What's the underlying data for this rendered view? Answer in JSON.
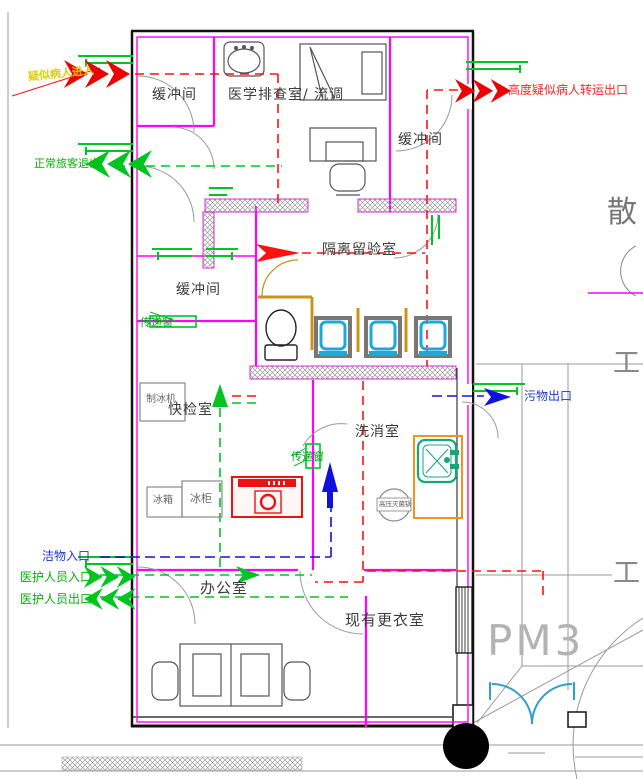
{
  "drawing": {
    "rooms": {
      "buffer_top_left": "缓冲间",
      "medical_screening": "医学排查室/ 流调",
      "buffer_top_right": "缓冲间",
      "isolation_room": "隔离留验室",
      "buffer_mid_left": "缓冲间",
      "rapid_test": "快检室",
      "wash_room": "洗消室",
      "office": "办公室",
      "changing_room": "现有更衣室"
    },
    "flows": {
      "suspected_entry": "疑似病人进入",
      "transfer_exit": "高度疑似病人转运出口",
      "normal_exit": "正常旅客退出",
      "waste_exit": "污物出口",
      "clean_entry": "洁物入口",
      "staff_entry": "医护人员入口",
      "staff_exit": "医护人员出口"
    },
    "equipment": {
      "ice_machine": "制冰机",
      "fridge": "冰箱",
      "freezer": "冰柜",
      "autoclave": "高压灭菌锅",
      "pass_window_upper": "传递窗",
      "pass_window_lower": "传递窗"
    },
    "annotations": {
      "pm3": "PM3",
      "scatter_partial": "散",
      "steel_1": "工",
      "steel_2": "工"
    },
    "colors": {
      "partition": "#ff00ff",
      "suspected_route": "#ff1111",
      "clean_route": "#00c422",
      "waste_route": "#1111dd",
      "stall_wood": "#c8941c",
      "door_blue": "#2f9fd0",
      "chair_cyan": "#18aadd"
    }
  }
}
